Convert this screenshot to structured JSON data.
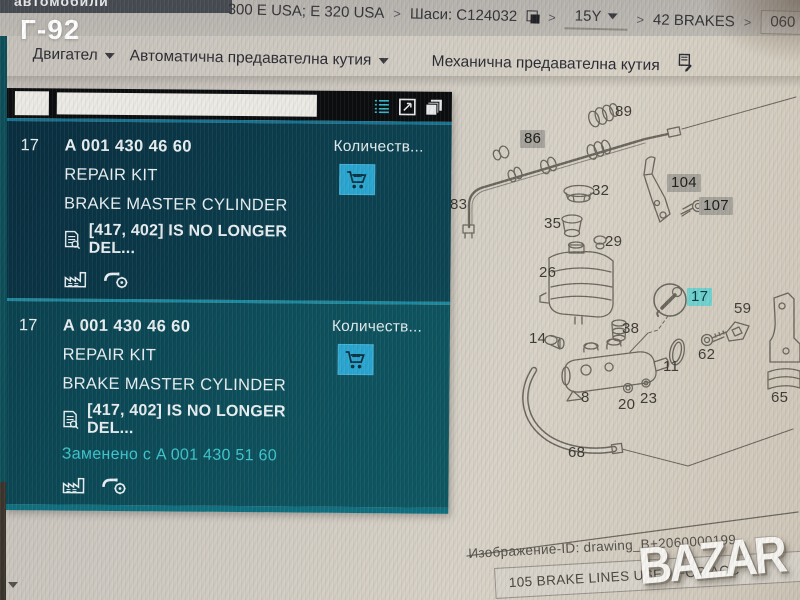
{
  "photo": {
    "sticker": "Г-92",
    "watermark": "BAZAR"
  },
  "breadcrumb": {
    "clipped_tab": "автомобили",
    "sep": ">",
    "model": "300 E USA; E 320 USA",
    "chassis": "Шаси: C124032",
    "year": "15Y",
    "group": "42 BRAKES",
    "subgroup": "060 BRAKE BOOSTER"
  },
  "menu": {
    "items": [
      {
        "label": "Двигател"
      },
      {
        "label": "Автоматична предавателна кутия"
      },
      {
        "label": "Механична предавателна кутия"
      }
    ]
  },
  "parts_panel": {
    "qty_header": "Количеств...",
    "items": [
      {
        "pos": "17",
        "part_number": "A 001 430 46 60",
        "line1": "REPAIR KIT",
        "line2": "BRAKE MASTER CYLINDER",
        "footnote": "[417, 402] IS NO LONGER DEL...",
        "replacement": ""
      },
      {
        "pos": "17",
        "part_number": "A 001 430 46 60",
        "line1": "REPAIR KIT",
        "line2": "BRAKE MASTER CYLINDER",
        "footnote": "[417, 402] IS NO LONGER DEL...",
        "replacement": "Заменено с A 001 430 51 60"
      }
    ]
  },
  "diagram": {
    "labels": [
      {
        "text": "89",
        "x": 615,
        "y": 103,
        "style": "plain"
      },
      {
        "text": "86",
        "x": 520,
        "y": 130,
        "style": "gray"
      },
      {
        "text": "83",
        "x": 450,
        "y": 196,
        "style": "plain"
      },
      {
        "text": "32",
        "x": 592,
        "y": 182,
        "style": "plain"
      },
      {
        "text": "104",
        "x": 667,
        "y": 174,
        "style": "gray"
      },
      {
        "text": "107",
        "x": 699,
        "y": 197,
        "style": "gray"
      },
      {
        "text": "35",
        "x": 544,
        "y": 215,
        "style": "plain"
      },
      {
        "text": "29",
        "x": 605,
        "y": 233,
        "style": "plain"
      },
      {
        "text": "26",
        "x": 539,
        "y": 264,
        "style": "plain"
      },
      {
        "text": "17",
        "x": 687,
        "y": 288,
        "style": "teal"
      },
      {
        "text": "59",
        "x": 734,
        "y": 300,
        "style": "plain"
      },
      {
        "text": "38",
        "x": 622,
        "y": 320,
        "style": "plain"
      },
      {
        "text": "14",
        "x": 529,
        "y": 330,
        "style": "plain"
      },
      {
        "text": "62",
        "x": 698,
        "y": 346,
        "style": "plain"
      },
      {
        "text": "11",
        "x": 663,
        "y": 358,
        "style": "plain"
      },
      {
        "text": "8",
        "x": 581,
        "y": 389,
        "style": "plain"
      },
      {
        "text": "20",
        "x": 618,
        "y": 396,
        "style": "plain"
      },
      {
        "text": "23",
        "x": 640,
        "y": 390,
        "style": "plain"
      },
      {
        "text": "65",
        "x": 771,
        "y": 389,
        "style": "plain"
      },
      {
        "text": "68",
        "x": 568,
        "y": 444,
        "style": "plain"
      }
    ]
  },
  "footer": {
    "image_id": "Изображение-ID: drawing_B+2060000199",
    "next_row": "105 BRAKE LINES USED FOR ACC"
  },
  "colors": {
    "panel_accent": "#1b8aa0",
    "cart_button": "#2ba6d0",
    "replacement_text": "#3ec6cd",
    "callout_gray": "#a6a49c",
    "callout_teal": "#72d2cf"
  }
}
